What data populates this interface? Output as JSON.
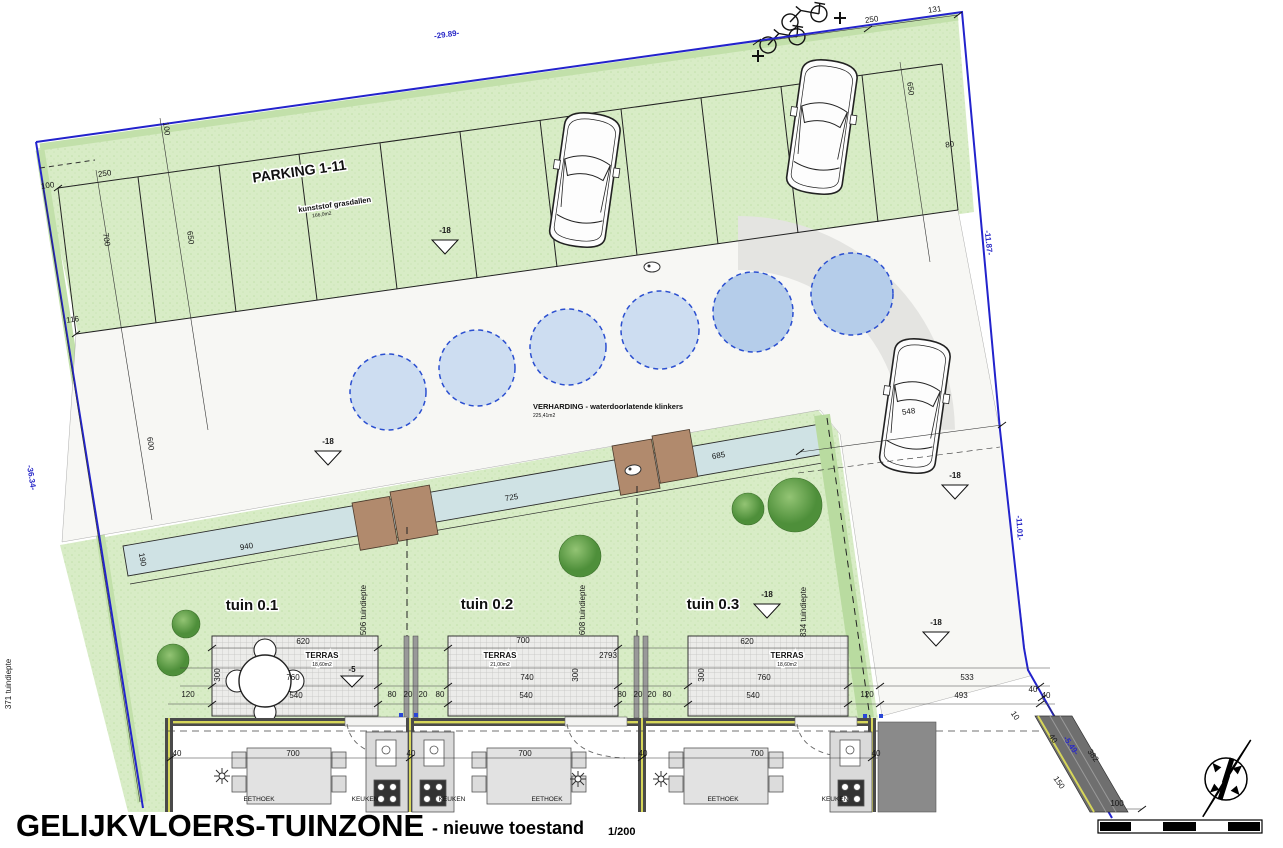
{
  "title": {
    "main": "GELIJKVLOERS-TUINZONE",
    "suffix": "- nieuwe toestand",
    "scale": "1/200"
  },
  "parking": {
    "label": "PARKING 1-11",
    "material": "kunststof grasdallen",
    "area": "166,0m2"
  },
  "verharding": {
    "label": "VERHARDING - waterdoorlatende klinkers",
    "area": "225,41m2"
  },
  "gardens": [
    {
      "label": "tuin 0.1"
    },
    {
      "label": "tuin 0.2"
    },
    {
      "label": "tuin 0.3"
    }
  ],
  "terraces": [
    {
      "label": "TERRAS",
      "area": "18,60m2"
    },
    {
      "label": "TERRAS",
      "area": "21,00m2"
    },
    {
      "label": "TERRAS",
      "area": "18,60m2"
    }
  ],
  "rooms": [
    "EETHOEK",
    "KEUKEN",
    "KEUKEN",
    "EETHOEK",
    "EETHOEK",
    "KEUKEN"
  ],
  "levels": {
    "ground": "-18",
    "terrace": "-5"
  },
  "colors": {
    "site_green": "#d8ecc6",
    "edge_green": "#b9dba0",
    "boundary_blue": "#2323cc",
    "water_teal": "#cfe2e4",
    "tree_green": "#4e8f3a",
    "shed_brown": "#b18a6d",
    "circle_blue_light": "#cdddf1",
    "circle_blue_dark": "#b5cdea",
    "wall_dark": "#4a4a4a",
    "insulation_yellow": "#d6d65a"
  },
  "dim_labels": [
    {
      "t": "-29.89-",
      "x": 447,
      "y": 37,
      "r": -8,
      "c": "blue",
      "n": "boundary-dim"
    },
    {
      "t": "-11.87-",
      "x": 986,
      "y": 243,
      "r": 84,
      "c": "blue",
      "n": "boundary-dim"
    },
    {
      "t": "-11.01-",
      "x": 1017,
      "y": 528,
      "r": 86,
      "c": "blue",
      "n": "boundary-dim"
    },
    {
      "t": "-36.34-",
      "x": 29,
      "y": 478,
      "r": 81,
      "c": "blue",
      "n": "boundary-dim"
    },
    {
      "t": "-5.49-",
      "x": 1069,
      "y": 747,
      "r": 55,
      "c": "blue",
      "n": "boundary-dim"
    },
    {
      "t": "250",
      "x": 872,
      "y": 22,
      "r": -8
    },
    {
      "t": "131",
      "x": 935,
      "y": 12,
      "r": -8
    },
    {
      "t": "100",
      "x": 48,
      "y": 188,
      "r": -8
    },
    {
      "t": "250",
      "x": 105,
      "y": 176,
      "r": -8
    },
    {
      "t": "700",
      "x": 104,
      "y": 240,
      "r": 81
    },
    {
      "t": "116",
      "x": 73,
      "y": 322,
      "r": -8
    },
    {
      "t": "100",
      "x": 164,
      "y": 129,
      "r": 82
    },
    {
      "t": "650",
      "x": 188,
      "y": 238,
      "r": 82
    },
    {
      "t": "600",
      "x": 148,
      "y": 444,
      "r": 82
    },
    {
      "t": "650",
      "x": 908,
      "y": 89,
      "r": 82
    },
    {
      "t": "80",
      "x": 950,
      "y": 147,
      "r": -8
    },
    {
      "t": "548",
      "x": 909,
      "y": 414,
      "r": -8
    },
    {
      "t": "940",
      "x": 247,
      "y": 549,
      "r": -10
    },
    {
      "t": "725",
      "x": 512,
      "y": 500,
      "r": -10
    },
    {
      "t": "685",
      "x": 719,
      "y": 458,
      "r": -10
    },
    {
      "t": "190",
      "x": 140,
      "y": 560,
      "r": 80
    },
    {
      "t": "506 tuindiepte",
      "x": 366,
      "y": 610,
      "r": -90,
      "s": 6,
      "n": "garden-depth-label"
    },
    {
      "t": "608 tuindiepte",
      "x": 585,
      "y": 610,
      "r": -90,
      "s": 6,
      "n": "garden-depth-label"
    },
    {
      "t": "834 tuindiepte",
      "x": 806,
      "y": 612,
      "r": -90,
      "s": 6,
      "n": "garden-depth-label"
    },
    {
      "t": "371 tuindiepte",
      "x": 11,
      "y": 684,
      "r": -90,
      "s": 6,
      "n": "garden-depth-label"
    },
    {
      "t": "620",
      "x": 303,
      "y": 644
    },
    {
      "t": "760",
      "x": 293,
      "y": 680
    },
    {
      "t": "540",
      "x": 296,
      "y": 698
    },
    {
      "t": "120",
      "x": 188,
      "y": 697
    },
    {
      "t": "300",
      "x": 220,
      "y": 675,
      "r": -90,
      "s": 7
    },
    {
      "t": "80",
      "x": 392,
      "y": 697,
      "s": 7
    },
    {
      "t": "20",
      "x": 408,
      "y": 697,
      "s": 7
    },
    {
      "t": "20",
      "x": 423,
      "y": 697,
      "s": 7
    },
    {
      "t": "80",
      "x": 440,
      "y": 697,
      "s": 7
    },
    {
      "t": "700",
      "x": 523,
      "y": 643
    },
    {
      "t": "2793",
      "x": 608,
      "y": 658
    },
    {
      "t": "740",
      "x": 527,
      "y": 680
    },
    {
      "t": "300",
      "x": 578,
      "y": 675,
      "r": -90,
      "s": 7
    },
    {
      "t": "540",
      "x": 526,
      "y": 698
    },
    {
      "t": "80",
      "x": 622,
      "y": 697,
      "s": 7
    },
    {
      "t": "20",
      "x": 638,
      "y": 697,
      "s": 7
    },
    {
      "t": "20",
      "x": 652,
      "y": 697,
      "s": 7
    },
    {
      "t": "80",
      "x": 667,
      "y": 697,
      "s": 7
    },
    {
      "t": "620",
      "x": 747,
      "y": 644
    },
    {
      "t": "760",
      "x": 764,
      "y": 680
    },
    {
      "t": "300",
      "x": 704,
      "y": 675,
      "r": -90,
      "s": 7
    },
    {
      "t": "540",
      "x": 753,
      "y": 698
    },
    {
      "t": "120",
      "x": 867,
      "y": 697
    },
    {
      "t": "533",
      "x": 967,
      "y": 680
    },
    {
      "t": "493",
      "x": 961,
      "y": 698
    },
    {
      "t": "40",
      "x": 1046,
      "y": 698,
      "s": 7
    },
    {
      "t": "40",
      "x": 177,
      "y": 756,
      "s": 7
    },
    {
      "t": "700",
      "x": 293,
      "y": 756
    },
    {
      "t": "40",
      "x": 411,
      "y": 756,
      "s": 7
    },
    {
      "t": "700",
      "x": 525,
      "y": 756
    },
    {
      "t": "40",
      "x": 643,
      "y": 756,
      "s": 7
    },
    {
      "t": "700",
      "x": 757,
      "y": 756
    },
    {
      "t": "40",
      "x": 876,
      "y": 756,
      "s": 7
    },
    {
      "t": "-18",
      "x": 445,
      "y": 233,
      "b": 1,
      "n": "level-marker-label"
    },
    {
      "t": "-18",
      "x": 328,
      "y": 444,
      "b": 1,
      "n": "level-marker-label"
    },
    {
      "t": "-18",
      "x": 955,
      "y": 478,
      "b": 1,
      "n": "level-marker-label"
    },
    {
      "t": "-18",
      "x": 767,
      "y": 597,
      "b": 1,
      "n": "level-marker-label"
    },
    {
      "t": "-18",
      "x": 936,
      "y": 625,
      "b": 1,
      "n": "level-marker-label"
    },
    {
      "t": "-5",
      "x": 352,
      "y": 672,
      "b": 1,
      "s": 7,
      "n": "level-marker-label"
    },
    {
      "t": "382",
      "x": 1091,
      "y": 757,
      "r": 55
    },
    {
      "t": "100",
      "x": 1117,
      "y": 806,
      "n": "scale-bar-dim"
    },
    {
      "t": "40",
      "x": 1033,
      "y": 692,
      "s": 7
    },
    {
      "t": "40",
      "x": 1051,
      "y": 740,
      "r": 55,
      "s": 6
    },
    {
      "t": "150",
      "x": 1057,
      "y": 784,
      "r": 55,
      "s": 6
    },
    {
      "t": "10",
      "x": 1013,
      "y": 717,
      "r": 55,
      "s": 6
    }
  ]
}
